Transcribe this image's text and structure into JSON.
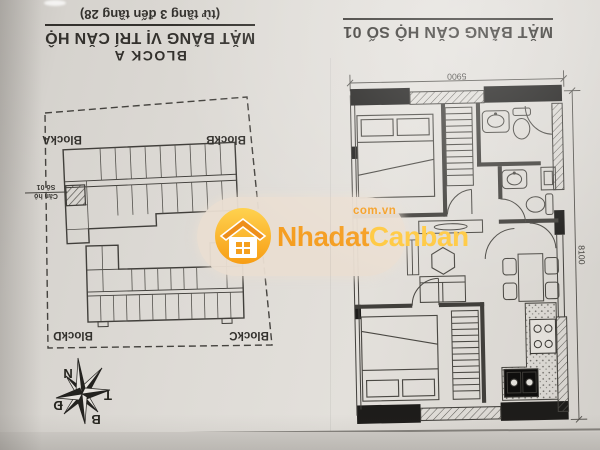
{
  "site_plan": {
    "block_heading": "BLOCK A",
    "title": "MẶT BẰNG VỊ TRÍ CĂN HỘ",
    "floors_note": "(từ tầng 3 đến tầng 28)",
    "blocks": {
      "a": "BlockA",
      "b": "BlockB",
      "c": "BlockC",
      "d": "BlockD"
    },
    "highlighted_unit": {
      "line1": "Căn hộ",
      "line2": "Số 01"
    }
  },
  "apartment_plan": {
    "title": "MẶT BẰNG CĂN HỘ SỐ 01",
    "dim_top": "5900",
    "dim_right": "8100"
  },
  "compass": {
    "top": "N",
    "right": "T",
    "left": "Đ",
    "bottom": "B"
  },
  "watermark": {
    "brand_first": "Nhadat",
    "brand_second": "Canban",
    "domain": "com.vn",
    "accent_orange": "#f59d1f",
    "accent_yellow": "#ffc83d",
    "pill_color": "#e9ded1"
  },
  "photo": {
    "paper_color": "#dedbd6",
    "ink_color": "#3c3a36"
  }
}
